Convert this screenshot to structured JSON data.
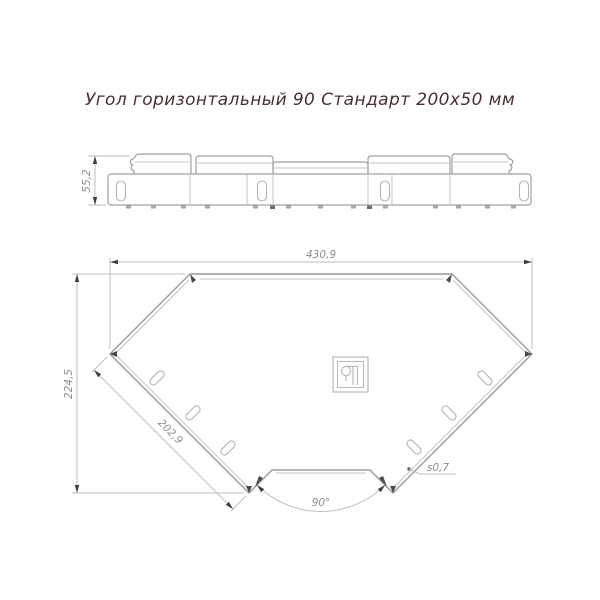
{
  "title": "Угол горизонтальный 90 Стандарт 200x50 мм",
  "colors": {
    "title_text": "#4a2e32",
    "drawing_lines": "#9a9a9a",
    "dimension_lines": "#bdbdbd",
    "dimension_text": "#8d8d8d"
  },
  "side_view": {
    "height_dim": "55,2"
  },
  "plan_view": {
    "width_dim": "430,9",
    "depth_dim": "224,5",
    "end_width_dim": "202,9",
    "angle_dim": "90°",
    "thickness_dim": "s0,7"
  }
}
